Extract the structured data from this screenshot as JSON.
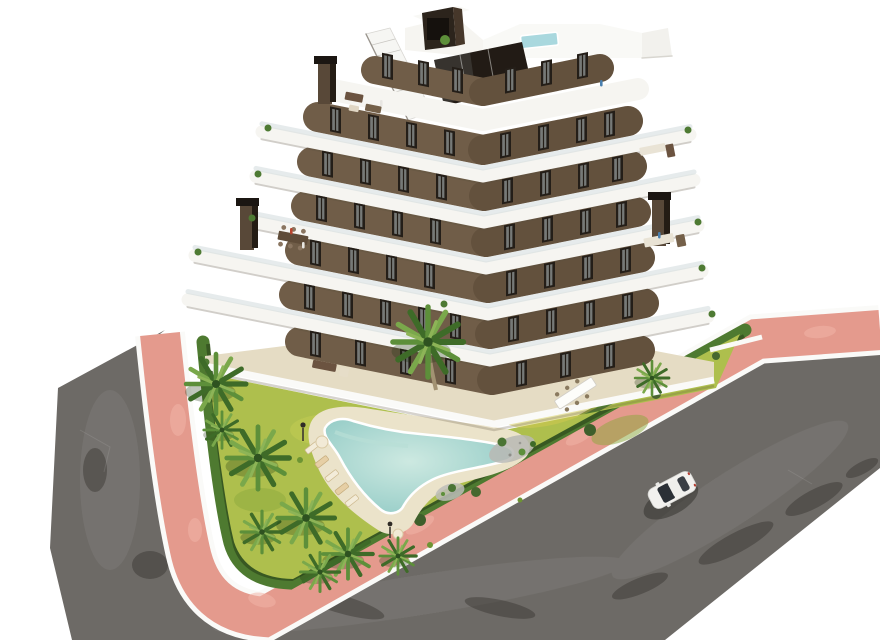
{
  "scene": {
    "kind": "architectural-aerial-3d-render",
    "description": "New-build stepped apartment block on a corner plot with landscaped pool garden, salmon-pink sidewalks, asphalt roads and a single white car",
    "camera": "high oblique aerial",
    "background": "pure white studio backdrop"
  },
  "colors": {
    "background": "#ffffff",
    "asphalt": "#6d6a66",
    "asphalt_patch": "#2e2a26",
    "sidewalk_pink": "#e49a8d",
    "sidewalk_light": "#f0b5a8",
    "curb_white": "#fafaf8",
    "hedge_green": "#4e7a30",
    "hedge_shadow": "#33501f",
    "lawn_green": "#aebf4d",
    "lawn_patch": "#d2c94f",
    "sand_deck": "#ebe3ca",
    "terrace_sand": "#e5dcc4",
    "pool_water": "#9ed2cb",
    "pool_water_light": "#c9e7df",
    "rooftop_pool": "#a9d8de",
    "wall_brown": "#705d48",
    "wall_dark": "#2c241c",
    "slab_white": "#f6f5f1",
    "window_dark": "#241e18",
    "glass_blue": "#cdd8da",
    "palm_dark": "#3e6b28",
    "palm_mid": "#5d8f3a",
    "palm_light": "#7aa84b",
    "trunk": "#a39272",
    "car_body": "#f2f1ee",
    "car_glass": "#2b3036",
    "shadow": "#1a1916"
  },
  "building": {
    "floors": 7,
    "style": "white wrap-around balcony slabs over dark brown walls, chevron plan",
    "chimneys": 3,
    "rooftop": {
      "plunge_pool": true,
      "penthouse": true,
      "external_stair": true
    },
    "window_count_estimate": 60
  },
  "garden": {
    "pool_shape": "freeform kidney",
    "sun_loungers": 5,
    "parasols": 2,
    "lamps": 2,
    "palm_trees": 10,
    "hedge": "clipped perimeter hedge",
    "gravel_beds": 2,
    "central_island": "sand island with large palm"
  },
  "streets": {
    "roads": 2,
    "surface": "asphalt",
    "sidewalk": "salmon pink pavers with white curbs",
    "car": {
      "count": 1,
      "color": "white",
      "heading": "southwest"
    }
  }
}
